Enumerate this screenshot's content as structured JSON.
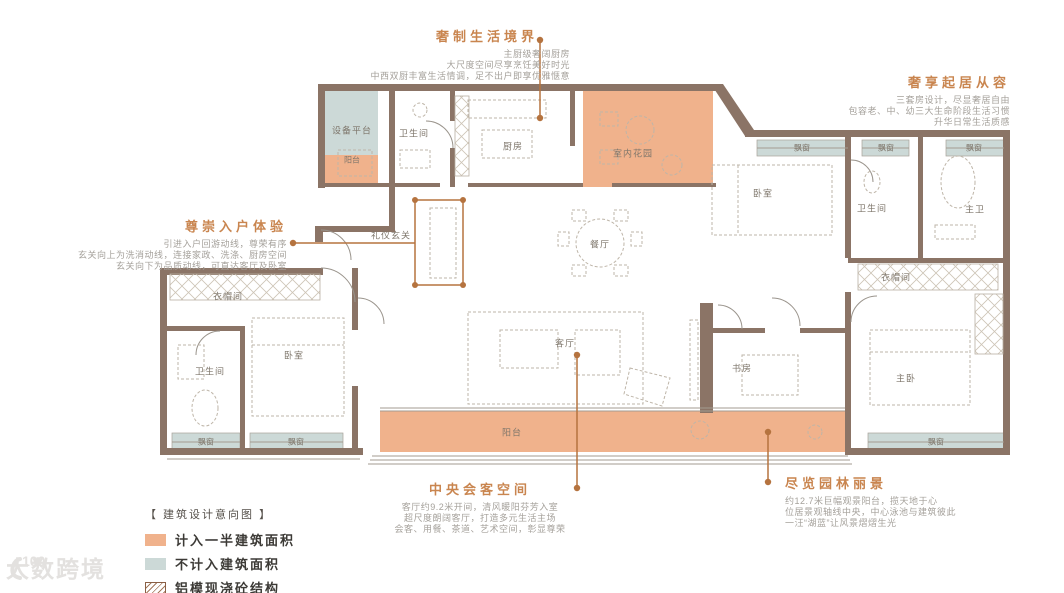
{
  "annotations": {
    "kitchen": {
      "title": "奢制生活境界",
      "lines": [
        "主厨级奢阔厨房",
        "大尺度空间尽享烹饪美好时光",
        "中西双厨丰富生活情调，足不出户即享优雅惬意"
      ]
    },
    "bedrooms": {
      "title": "奢享起居从容",
      "lines": [
        "三套房设计，尽显奢居自由",
        "包容老、中、幼三大生命阶段生活习惯",
        "升华日常生活质感"
      ]
    },
    "foyer": {
      "title": "尊崇入户体验",
      "lines": [
        "引进入户回游动线，尊荣有序",
        "玄关向上为洗消动线，连接家政、洗涤、厨房空间",
        "玄关向下为品质动线，可直达客厅及卧室"
      ]
    },
    "living": {
      "title": "中央会客空间",
      "lines": [
        "客厅约9.2米开间，清风暖阳芬芳入室",
        "超尺度朗阔客厅，打造多元生活主场",
        "会客、用餐、茶道、艺术空间，彰显尊荣"
      ]
    },
    "balcony": {
      "title": "尽览园林丽景",
      "lines": [
        "约12.7米巨幅观景阳台，揽天地于心",
        "位居景观轴线中央，中心泳池与建筑彼此",
        "一汪“湖蓝”让风景熠熠生光"
      ]
    }
  },
  "labels": {
    "equipment": "设备平台",
    "balcony": "阳台",
    "bath": "卫生间",
    "kitchen": "厨房",
    "garden": "室内花园",
    "foyer": "礼仪玄关",
    "dining": "餐厅",
    "living": "客厅",
    "bedroom": "卧室",
    "master_bath": "主卫",
    "master_bed": "主卧",
    "closet": "衣帽间",
    "study": "书房",
    "bay": "飘窗"
  },
  "legend": {
    "title": "【 建筑设计意向图 】",
    "items": [
      {
        "label": "计入一半建筑面积",
        "color": "#f0b28c"
      },
      {
        "label": "不计入建筑面积",
        "color": "#ccd9d7"
      },
      {
        "label": "铝模现浇砼结构",
        "color": "hatch"
      }
    ]
  },
  "colors": {
    "wall": "#8b7466",
    "callout": "#b5733f",
    "half_area_fill": "#f0b28c",
    "excluded_fill": "#ccd9d7"
  },
  "watermark": {
    "icon": "100",
    "text": "大数跨境"
  }
}
